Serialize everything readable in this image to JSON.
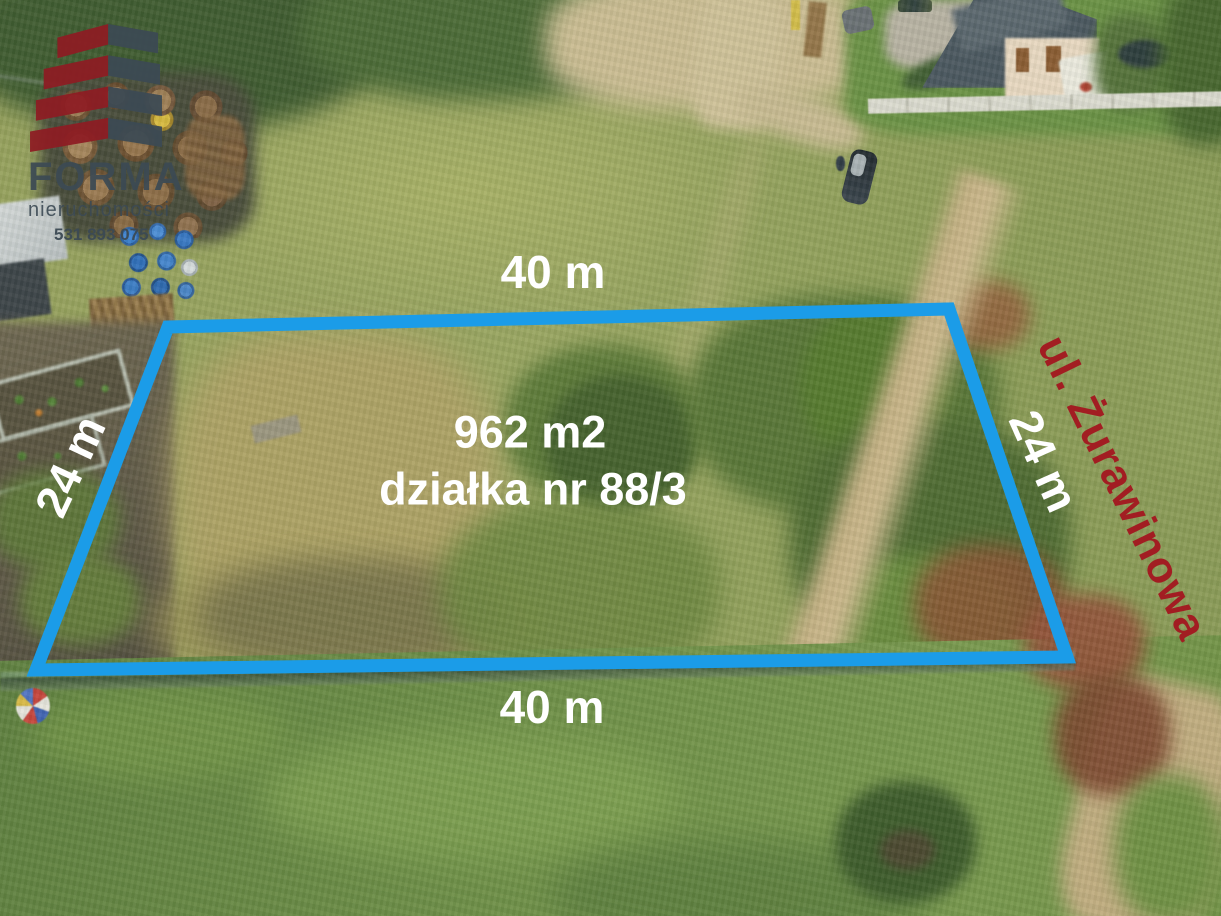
{
  "annotations": {
    "dim_top": "40 m",
    "dim_bottom": "40 m",
    "dim_left": "24 m",
    "dim_right": "24 m",
    "area": "962 m2",
    "parcel": "działka nr 88/3",
    "street": "ul. Żurawinowa"
  },
  "watermark": {
    "brand": "FORMA",
    "tagline": "nieruchomości",
    "phone": "531 893 075"
  },
  "colors": {
    "outline": "#1b9ce8",
    "dimension_text": "#ffffff",
    "street_text": "#a21d22",
    "logo_red": "#8e1c23",
    "logo_slate": "#3c4a54"
  }
}
